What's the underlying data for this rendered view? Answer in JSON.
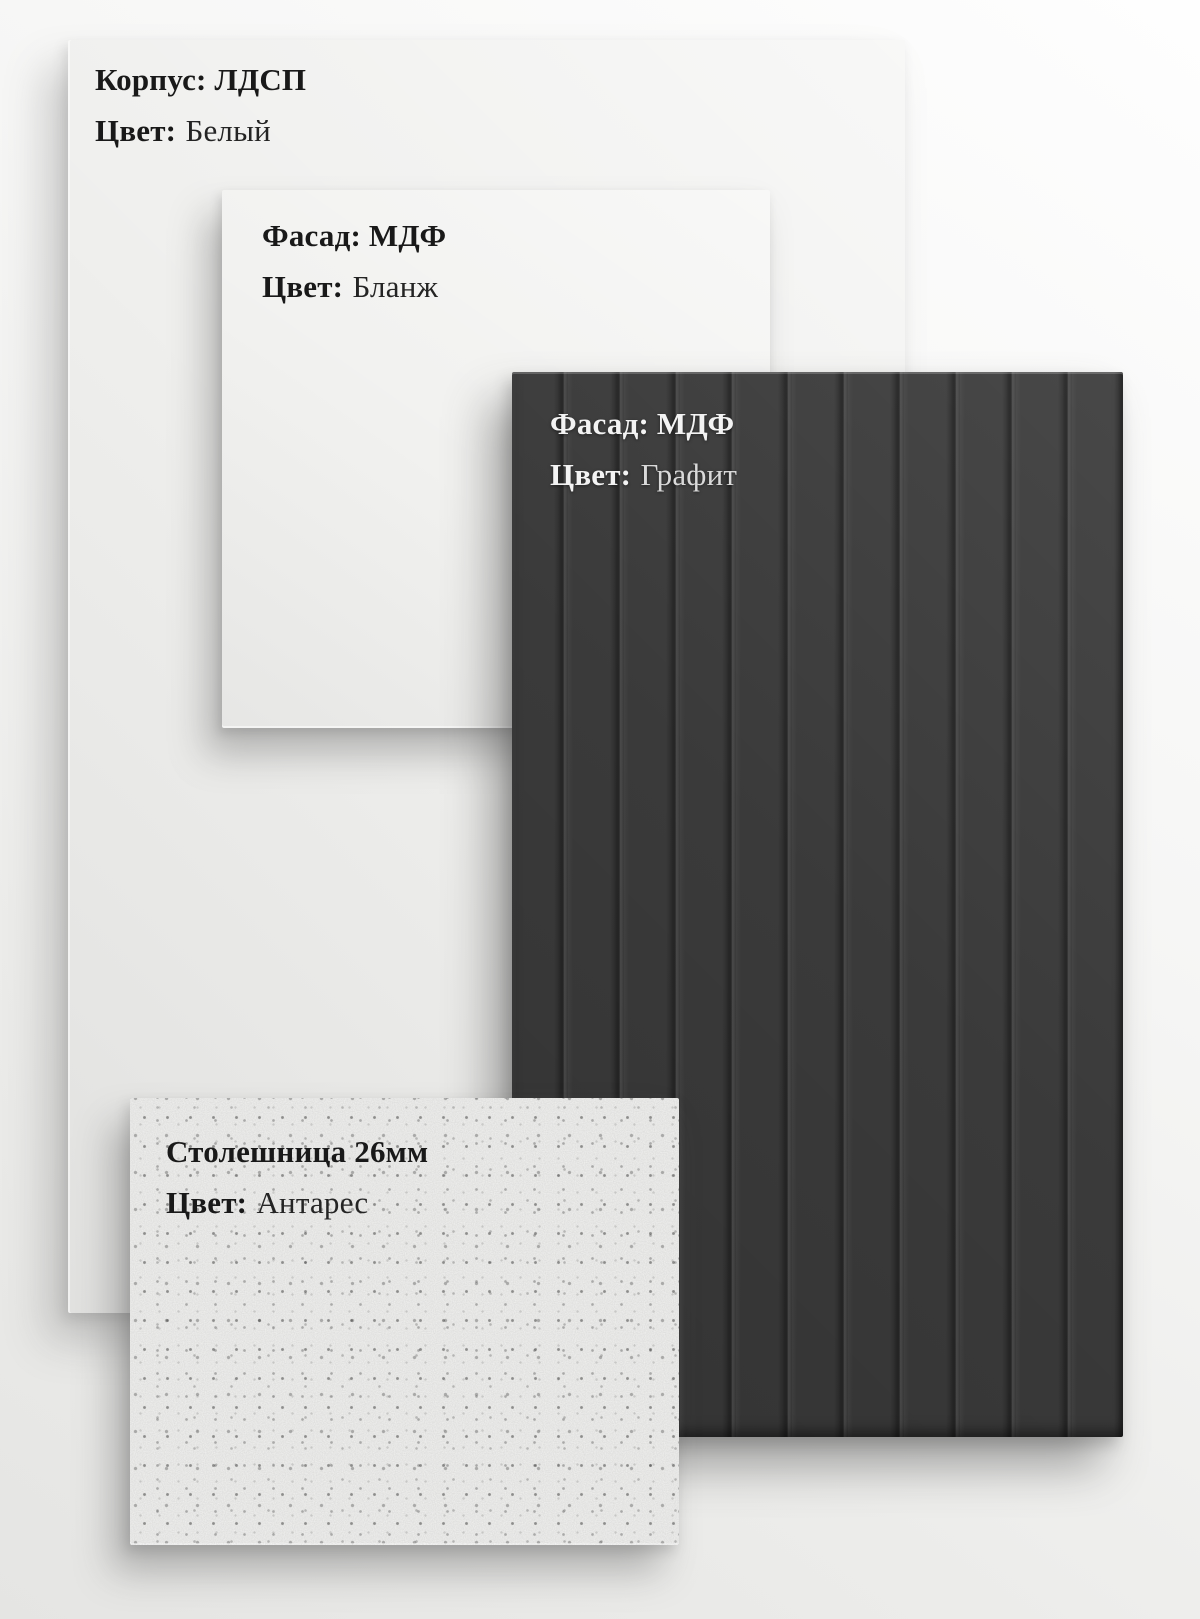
{
  "panels": {
    "korpus": {
      "material": "Корпус: ЛДСП",
      "color_label": "Цвет:",
      "color_value": "Белый"
    },
    "fasad_blanzh": {
      "material": "Фасад: МДФ",
      "color_label": "Цвет:",
      "color_value": "Бланж"
    },
    "fasad_grafit": {
      "material": "Фасад: МДФ",
      "color_label": "Цвет:",
      "color_value": "Графит"
    },
    "stoleshnitsa": {
      "material": "Столешница 26мм",
      "color_label": "Цвет:",
      "color_value": "Антарес"
    }
  },
  "colors": {
    "background_top_right": "#fdfdfd",
    "background_bottom_left": "#e5e5e3",
    "korpus_panel": "#efefed",
    "blanzh_panel": "#f1f1ef",
    "grafit_panel": "#3a3a3a",
    "grafit_groove": "#262626",
    "stoleshnitsa_panel": "#f3f3f1",
    "label_dark": "#191919",
    "label_light": "#f3f3f3"
  }
}
